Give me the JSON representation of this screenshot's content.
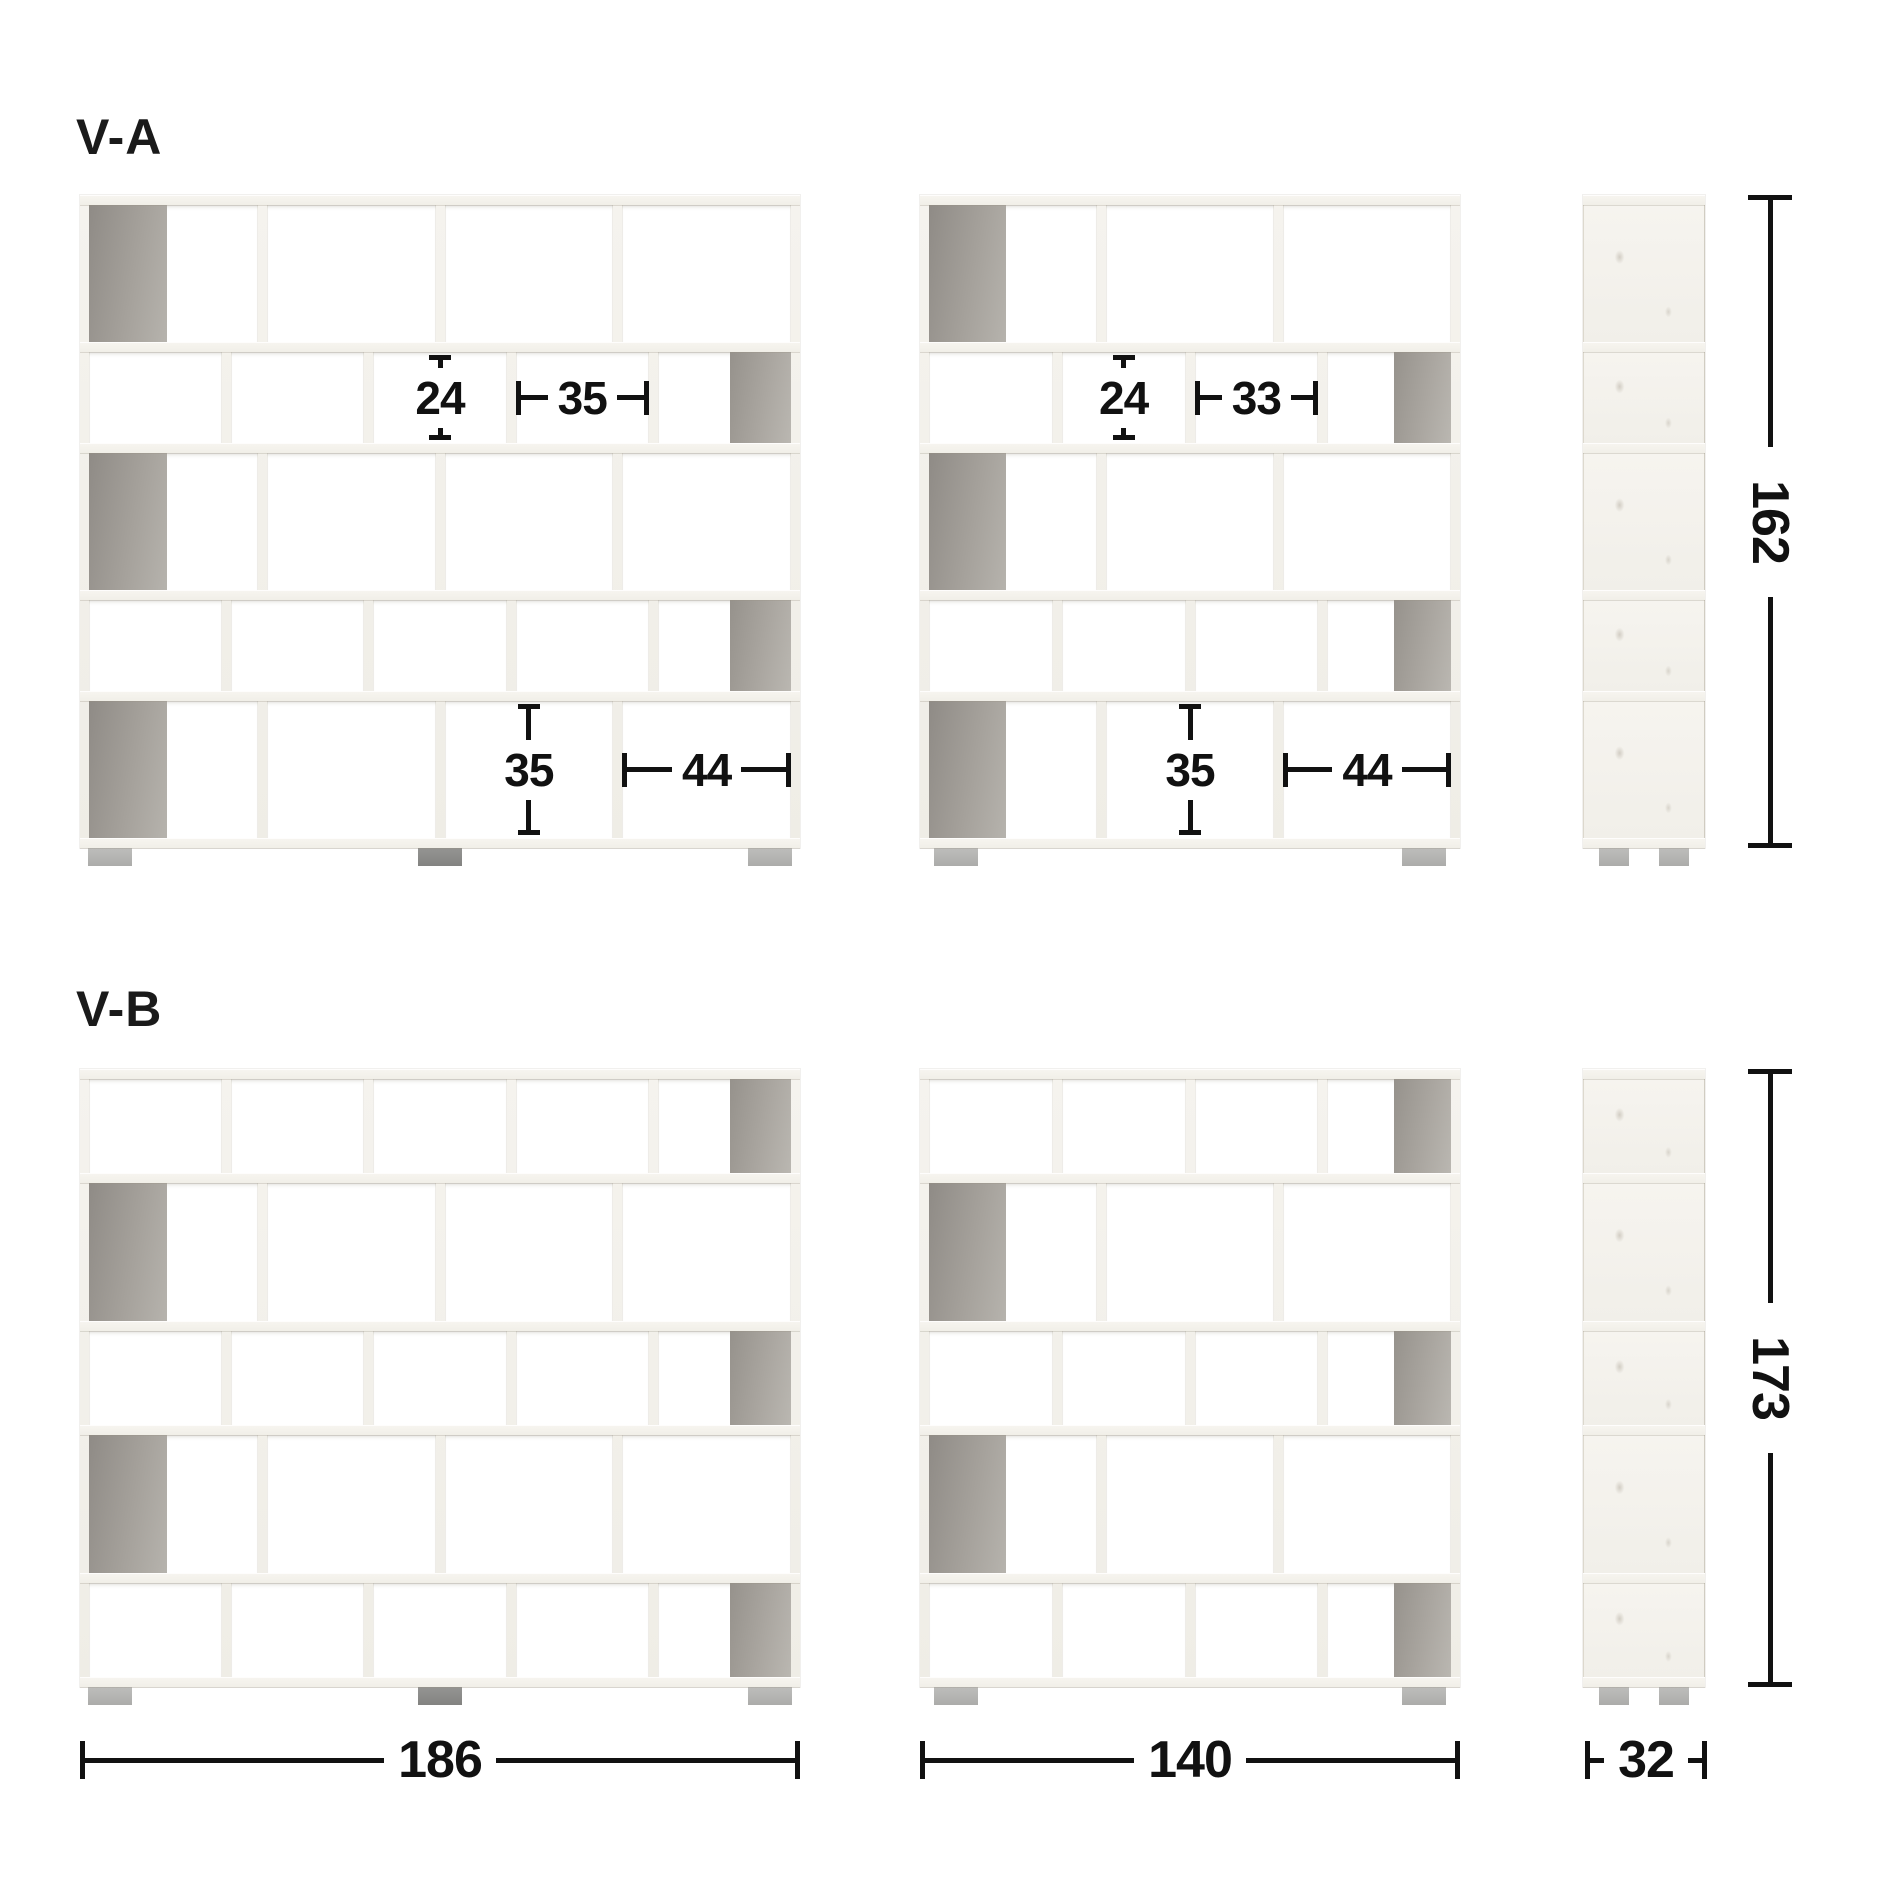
{
  "variants": [
    {
      "label": "V-A",
      "height_dim": "162",
      "units": [
        {
          "name": "va-front-wide",
          "kind": "wide",
          "feet": [
            "light",
            "dark",
            "light"
          ],
          "rows": [
            {
              "size": "tall",
              "cols": 4,
              "gray": "first"
            },
            {
              "size": "short",
              "cols": 5,
              "gray": "last"
            },
            {
              "size": "tall",
              "cols": 4,
              "gray": "first"
            },
            {
              "size": "short",
              "cols": 5,
              "gray": "last"
            },
            {
              "size": "tall",
              "cols": 4,
              "gray": "first"
            }
          ],
          "annotations": [
            {
              "kind": "v",
              "value": "24",
              "row": 1,
              "col": 2
            },
            {
              "kind": "h",
              "value": "35",
              "row": 1,
              "col": 3
            },
            {
              "kind": "v",
              "value": "35",
              "row": 4,
              "col": 2
            },
            {
              "kind": "h",
              "value": "44",
              "row": 4,
              "col": 3
            }
          ]
        },
        {
          "name": "va-front-narrow",
          "kind": "narrow",
          "feet": [
            "light",
            "light"
          ],
          "rows": [
            {
              "size": "tall",
              "cols": 3,
              "gray": "first"
            },
            {
              "size": "short",
              "cols": 4,
              "gray": "last"
            },
            {
              "size": "tall",
              "cols": 3,
              "gray": "first"
            },
            {
              "size": "short",
              "cols": 4,
              "gray": "last"
            },
            {
              "size": "tall",
              "cols": 3,
              "gray": "first"
            }
          ],
          "annotations": [
            {
              "kind": "v",
              "value": "24",
              "row": 1,
              "col": 1
            },
            {
              "kind": "h",
              "value": "33",
              "row": 1,
              "col": 2
            },
            {
              "kind": "v",
              "value": "35",
              "row": 4,
              "col": 1
            },
            {
              "kind": "h",
              "value": "44",
              "row": 4,
              "col": 2
            }
          ]
        },
        {
          "name": "va-side",
          "kind": "side",
          "feet": [
            "light",
            "light"
          ],
          "sections": [
            "tall",
            "short",
            "tall",
            "short",
            "tall"
          ]
        }
      ]
    },
    {
      "label": "V-B",
      "height_dim": "173",
      "units": [
        {
          "name": "vb-front-wide",
          "kind": "wide",
          "feet": [
            "light",
            "dark",
            "light"
          ],
          "rows": [
            {
              "size": "short",
              "cols": 5,
              "gray": "last"
            },
            {
              "size": "tall",
              "cols": 4,
              "gray": "first"
            },
            {
              "size": "short",
              "cols": 5,
              "gray": "last"
            },
            {
              "size": "tall",
              "cols": 4,
              "gray": "first"
            },
            {
              "size": "short",
              "cols": 5,
              "gray": "last"
            }
          ],
          "annotations": []
        },
        {
          "name": "vb-front-narrow",
          "kind": "narrow",
          "feet": [
            "light",
            "light"
          ],
          "rows": [
            {
              "size": "short",
              "cols": 4,
              "gray": "last"
            },
            {
              "size": "tall",
              "cols": 3,
              "gray": "first"
            },
            {
              "size": "short",
              "cols": 4,
              "gray": "last"
            },
            {
              "size": "tall",
              "cols": 3,
              "gray": "first"
            },
            {
              "size": "short",
              "cols": 4,
              "gray": "last"
            }
          ],
          "annotations": []
        },
        {
          "name": "vb-side",
          "kind": "side",
          "feet": [
            "light",
            "light"
          ],
          "sections": [
            "short",
            "tall",
            "short",
            "tall",
            "short"
          ]
        }
      ]
    }
  ],
  "width_dims": [
    {
      "name": "wide-width",
      "value": "186"
    },
    {
      "name": "narrow-width",
      "value": "140"
    },
    {
      "name": "depth",
      "value": "32"
    }
  ],
  "colors": {
    "background": "#ffffff",
    "frame_wood": "#f3f1ec",
    "cell": "#ffffff",
    "back_panel_gray": "#a29e98",
    "foot_light": "#b7b7b5",
    "foot_dark": "#8d8d8b",
    "dimension": "#111111"
  }
}
